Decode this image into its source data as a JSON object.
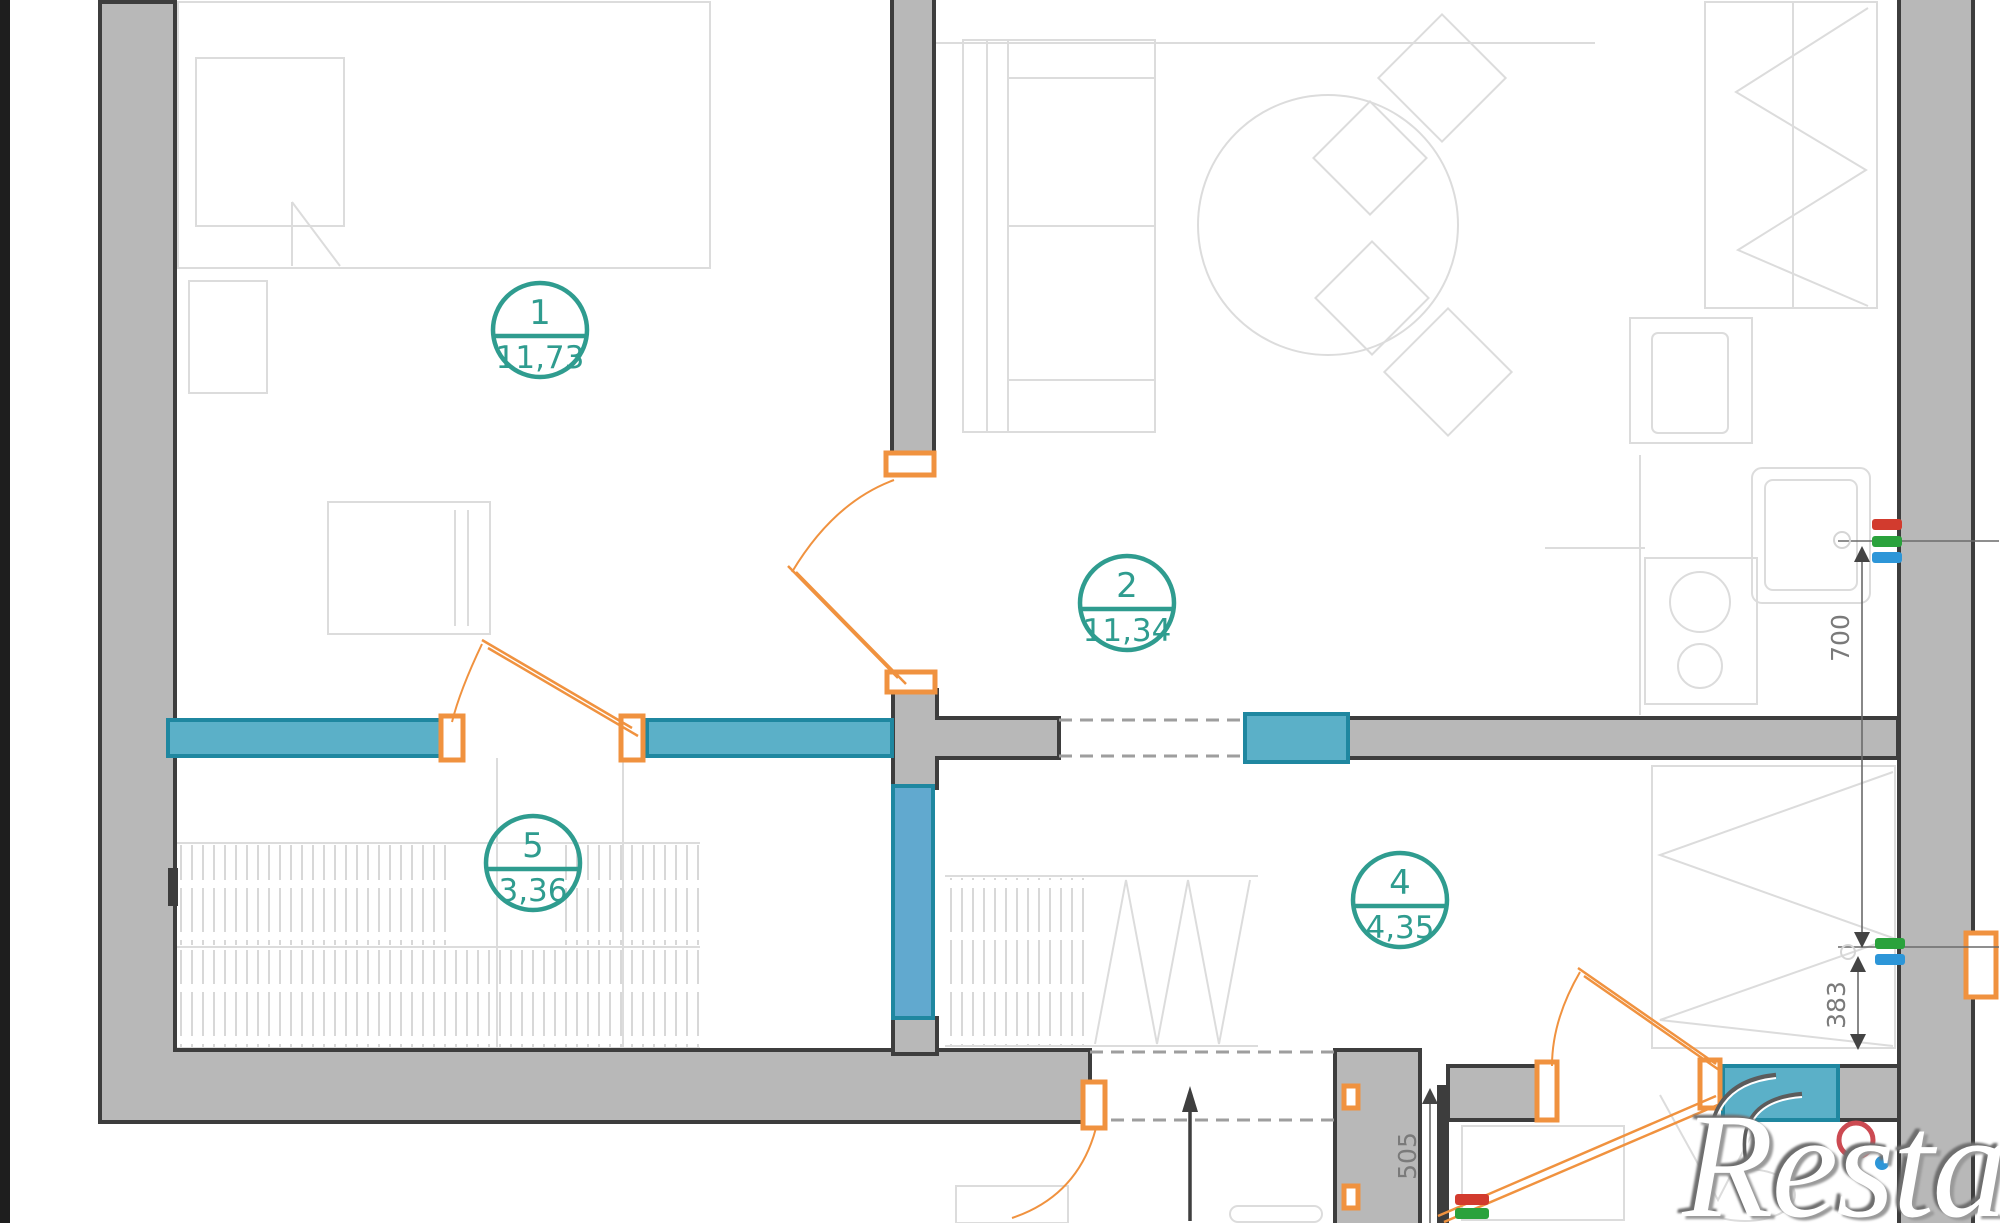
{
  "plan": {
    "title": "apartment-floor-plan",
    "rooms": [
      {
        "number": "1",
        "area": "11,73"
      },
      {
        "number": "2",
        "area": "11,34"
      },
      {
        "number": "5",
        "area": "3,36"
      },
      {
        "number": "4",
        "area": "4,35"
      }
    ],
    "dimensions": [
      {
        "label": "700"
      },
      {
        "label": "383"
      },
      {
        "label": "505"
      }
    ],
    "watermark": "Restate",
    "icons": {
      "entry_arrow": "filled triangle arrow pointing up at entrance opening",
      "toilet_ring": "red circle outline",
      "hot_water_dot": "red filled dot",
      "cold_water_dot": "blue filled dot",
      "riser_bars": "red/green/blue stacked bars on right wall"
    },
    "colors": {
      "wall_fill": "#b8b8b8",
      "wall_stroke": "#3d3d3d",
      "window_fill": "#5bb0c8",
      "window_stroke": "#1f87a0",
      "door": "#f0923f",
      "room_label": "#2f9c8f",
      "dimension_text": "#7a7a7a",
      "mark_red": "#d23b2e",
      "mark_green": "#2aa23c",
      "mark_blue": "#2d96d8",
      "furniture_line": "#dcdcdc"
    }
  }
}
